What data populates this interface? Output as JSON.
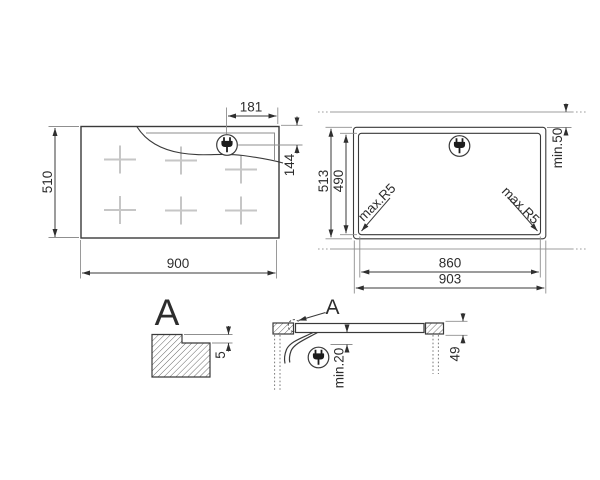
{
  "top_view": {
    "width": "900",
    "height": "510",
    "plug_from_right": "181",
    "plug_from_top": "144"
  },
  "cutout_view": {
    "outer_width": "903",
    "inner_width": "860",
    "outer_height": "513",
    "inner_height": "490",
    "rear_clearance": "min.50",
    "corner_radius_left": "max.R5",
    "corner_radius_right": "max.R5"
  },
  "detail_view": {
    "label": "A",
    "ledge_depth": "5"
  },
  "section_view": {
    "label": "A",
    "bottom_clearance": "min.20",
    "build_in_depth": "49"
  }
}
